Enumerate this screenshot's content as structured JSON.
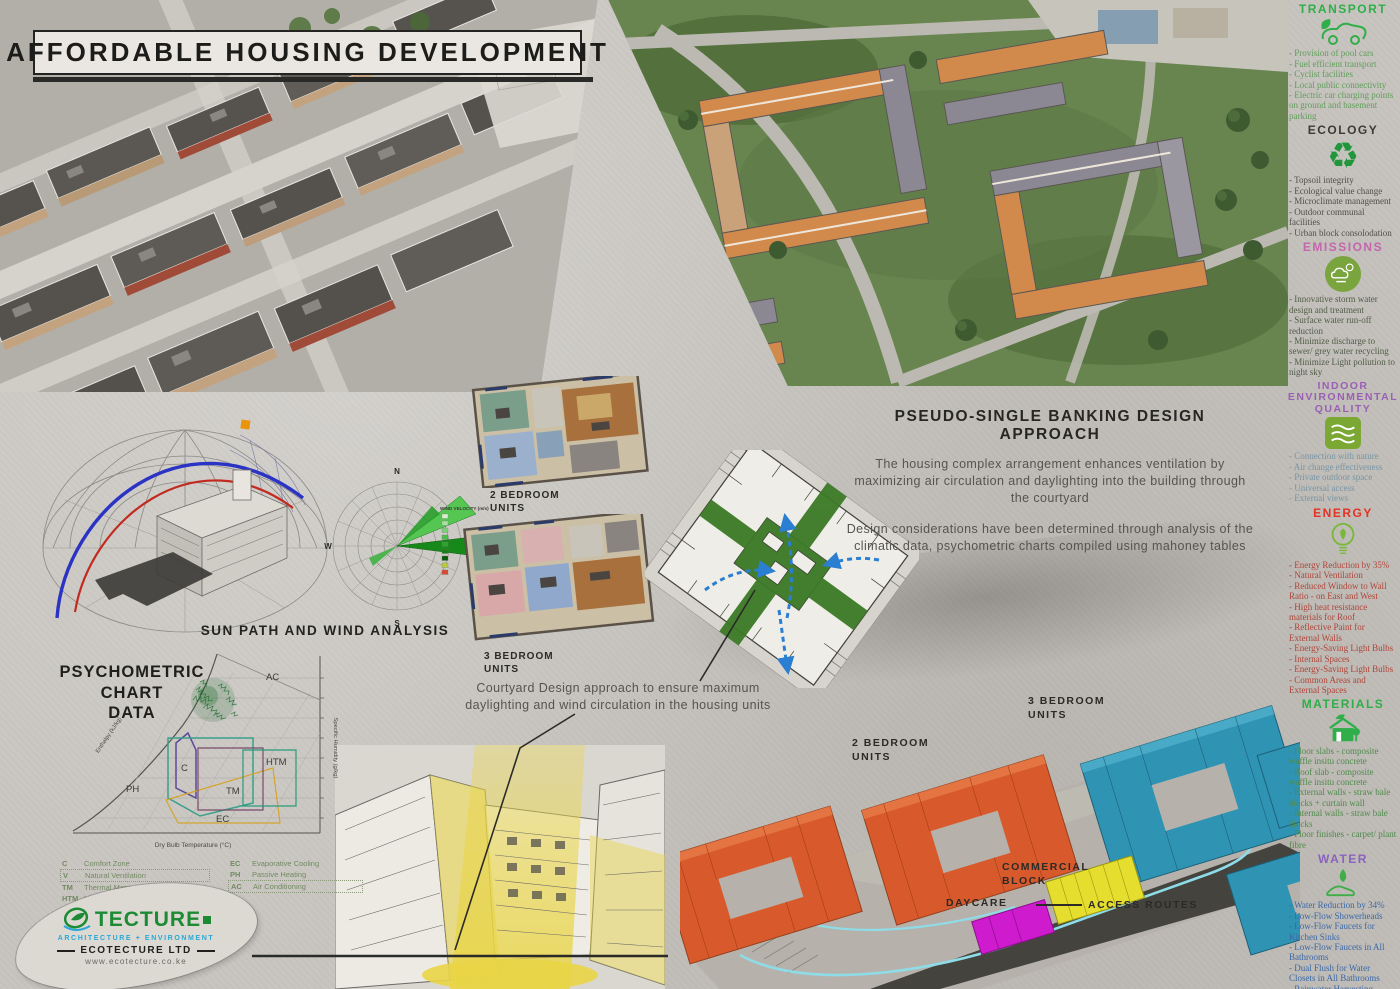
{
  "title": "AFFORDABLE HOUSING DEVELOPMENT",
  "design_approach": {
    "heading": "PSEUDO-SINGLE BANKING DESIGN APPROACH",
    "paragraph1": "The housing complex arrangement enhances ventilation by maximizing air circulation and daylighting into the building through the courtyard",
    "paragraph2": "Design considerations have been determined through analysis of the climatic data, psychometric charts compiled using mahoney tables"
  },
  "courtyard_caption": "Courtyard Design approach to ensure maximum daylighting and wind circulation in the housing units",
  "sun_wind": {
    "title": "SUN PATH AND WIND ANALYSIS",
    "wind_rose": {
      "legend_title": "WIND VELOCITY (m/s)",
      "compass": [
        "N",
        "E",
        "S",
        "W"
      ],
      "legend_colors": [
        "#d8f0d0",
        "#a8e0a0",
        "#78d078",
        "#48bf48",
        "#2aa42a",
        "#187f18",
        "#0a5c0a",
        "#b8cc3c",
        "#d84a32"
      ]
    }
  },
  "psychometric": {
    "heading": "PSYCHOMETRIC CHART\nDATA",
    "xlabel": "Dry Bulb Temperature (°C)",
    "ylabel_right": "Specific Humidity (g/kg)",
    "enthalpy_label": "Enthalpy (kJ/kg)",
    "zones": [
      "AC",
      "C",
      "PH",
      "TM",
      "EC",
      "HTM"
    ],
    "legend_left": [
      [
        "C",
        "Comfort Zone"
      ],
      [
        "V",
        "Natural Ventilation"
      ],
      [
        "TM",
        "Thermal Mass"
      ],
      [
        "HTM",
        "High Thermal Mass"
      ]
    ],
    "legend_right": [
      [
        "EC",
        "Evaporative Cooling"
      ],
      [
        "PH",
        "Passive Heating"
      ],
      [
        "AC",
        "Air Conditioning"
      ]
    ]
  },
  "floor_plans": {
    "two_bedroom_label": "2 BEDROOM\nUNITS",
    "three_bedroom_label": "3 BEDROOM\nUNITS"
  },
  "site_plan": {
    "labels": {
      "two_bedroom": "2 BEDROOM\nUNITS",
      "three_bedroom": "3 BEDROOM\nUNITS",
      "commercial": "COMMERCIAL\nBLOCK",
      "daycare": "DAYCARE",
      "access_routes": "ACCESS ROUTES"
    },
    "colors": {
      "two_bedroom": "#d85a2c",
      "three_bedroom": "#2f93b4",
      "commercial": "#e5de2f",
      "daycare": "#ce1bce",
      "access_route": "#8fdce9"
    }
  },
  "sidebar": {
    "sections": [
      {
        "heading": "TRANSPORT",
        "icon": "car-leaf-icon",
        "heading_color": "#2fae49",
        "items": [
          "- Provision of pool cars",
          "- Fuel efficient transport",
          "- Cyclist facilities",
          "- Local public connectivity",
          "- Electric car charging points on ground and basement parking"
        ]
      },
      {
        "heading": "ECOLOGY",
        "icon": "recycle-icon",
        "heading_color": "#3a3a36",
        "items": [
          "- Topsoil integrity",
          "- Ecological value change",
          "- Microclimate management",
          "- Outdoor communal facilities",
          "- Urban block consolodation"
        ]
      },
      {
        "heading": "EMISSIONS",
        "icon": "storm-water-icon",
        "heading_color": "#c465ae",
        "items": [
          "- Innovative storm water design and treatment",
          "- Surface water run-off reduction",
          "- Minimize discharge to sewer/ grey water recycling",
          "- Minimize Light pollution to night sky"
        ]
      },
      {
        "heading": "INDOOR ENVIRONMENTAL\nQUALITY",
        "icon": "air-quality-icon",
        "heading_color": "#9a5fb5",
        "items": [
          "- Connection with nature",
          "- Air change effectiveness",
          "- Private outdoor space",
          "- Universal access",
          "- External views"
        ]
      },
      {
        "heading": "ENERGY",
        "icon": "eco-bulb-icon",
        "heading_color": "#e53225",
        "items": [
          "- Energy Reduction by 35%",
          "- Natural Ventilation",
          "- Reduced Window to Wall Ratio - on East and West",
          "- High heat resistance materials for Roof",
          "- Reflective Paint for External Walls",
          "- Energy-Saving Light Bulbs - Internal Spaces",
          "- Energy-Saving Light Bulbs - Common Areas and External Spaces"
        ]
      },
      {
        "heading": "MATERIALS",
        "icon": "eco-house-icon",
        "heading_color": "#2fae49",
        "items": [
          "- Floor slabs - composite waffle insitu concrete",
          "- Roof slab - composite waffle insitu concrete",
          "- External walls - straw bale blocks + curtain wall",
          "- Internal walls - straw bale blocks",
          "- Floor finishes - carpet/ plant fibre"
        ]
      },
      {
        "heading": "WATER",
        "icon": "water-hand-icon",
        "heading_color": "#8a62c0",
        "items": [
          "- Water Reduction by 34%",
          "- Low-Flow Showerheads",
          "- Low-Flow Faucets for Kitchen Sinks",
          "- Low-Flow Faucets in All Bathrooms",
          "- Dual Flush for Water Closets in All Bathrooms",
          "- Rainwater Harvesting System",
          "- Recycled Grey Water for gardening and outdoor cleaning"
        ]
      }
    ]
  },
  "logo": {
    "brand": "TECTURE",
    "tagline": "ARCHITECTURE + ENVIRONMENT",
    "company": "ECOTECTURE LTD",
    "website": "www.ecotecture.co.ke"
  }
}
